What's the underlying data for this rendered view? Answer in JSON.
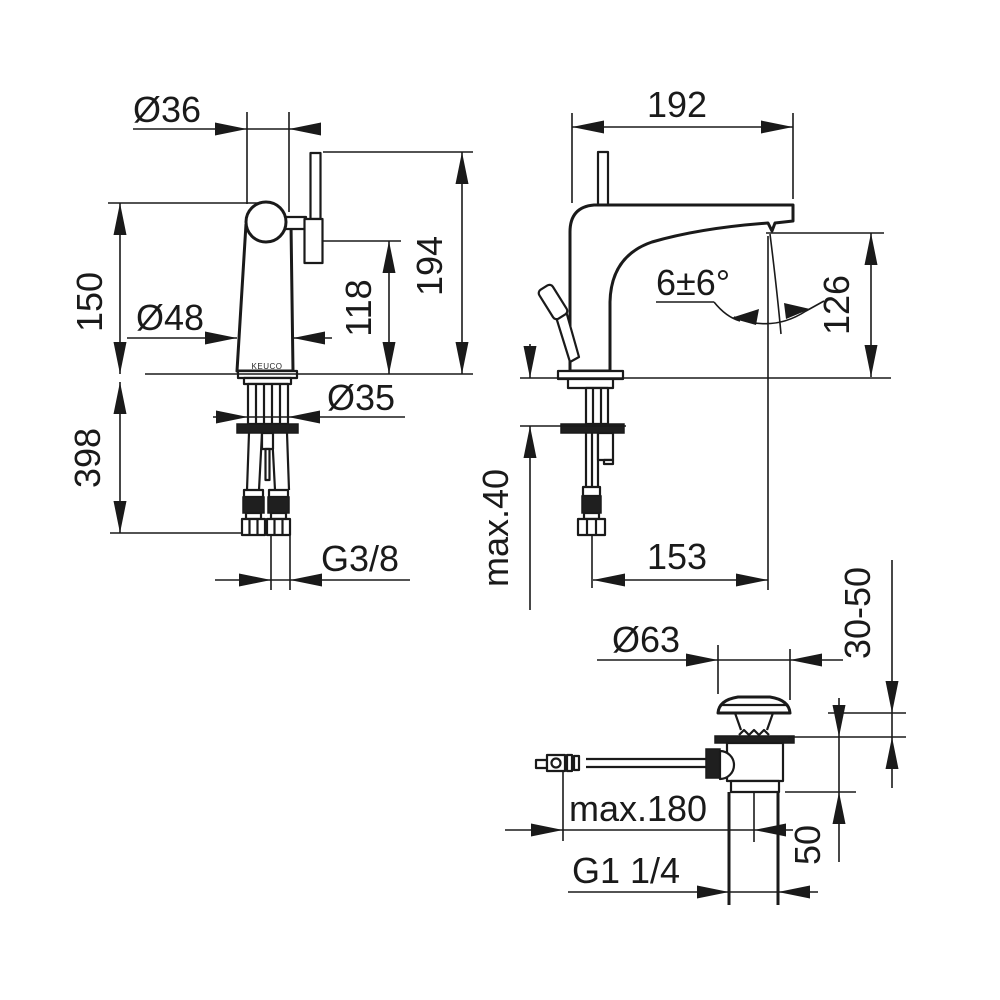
{
  "page": {
    "background": "#ffffff",
    "line_color": "#1a1a1a",
    "description_labels_only": "technical dimension drawing of single-lever basin faucet with pop-up waste"
  },
  "brand": "KEUCO",
  "front_view": {
    "top_diameter": "Ø36",
    "upper_height": "150",
    "body_diameter": "Ø48",
    "spout_height": "118",
    "total_height": "194",
    "below_counter_length": "398",
    "shank_diameter": "Ø35",
    "supply_thread": "G3/8"
  },
  "side_view": {
    "spout_reach": "192",
    "stream_angle": "6±6°",
    "outlet_height": "126",
    "counter_thickness": "max.40",
    "outlet_offset": "153"
  },
  "drain_view": {
    "cap_diameter": "Ø63",
    "mount_range": "30-50",
    "body_height": "50",
    "rod_reach": "max.180",
    "waste_thread": "G1 1/4"
  }
}
